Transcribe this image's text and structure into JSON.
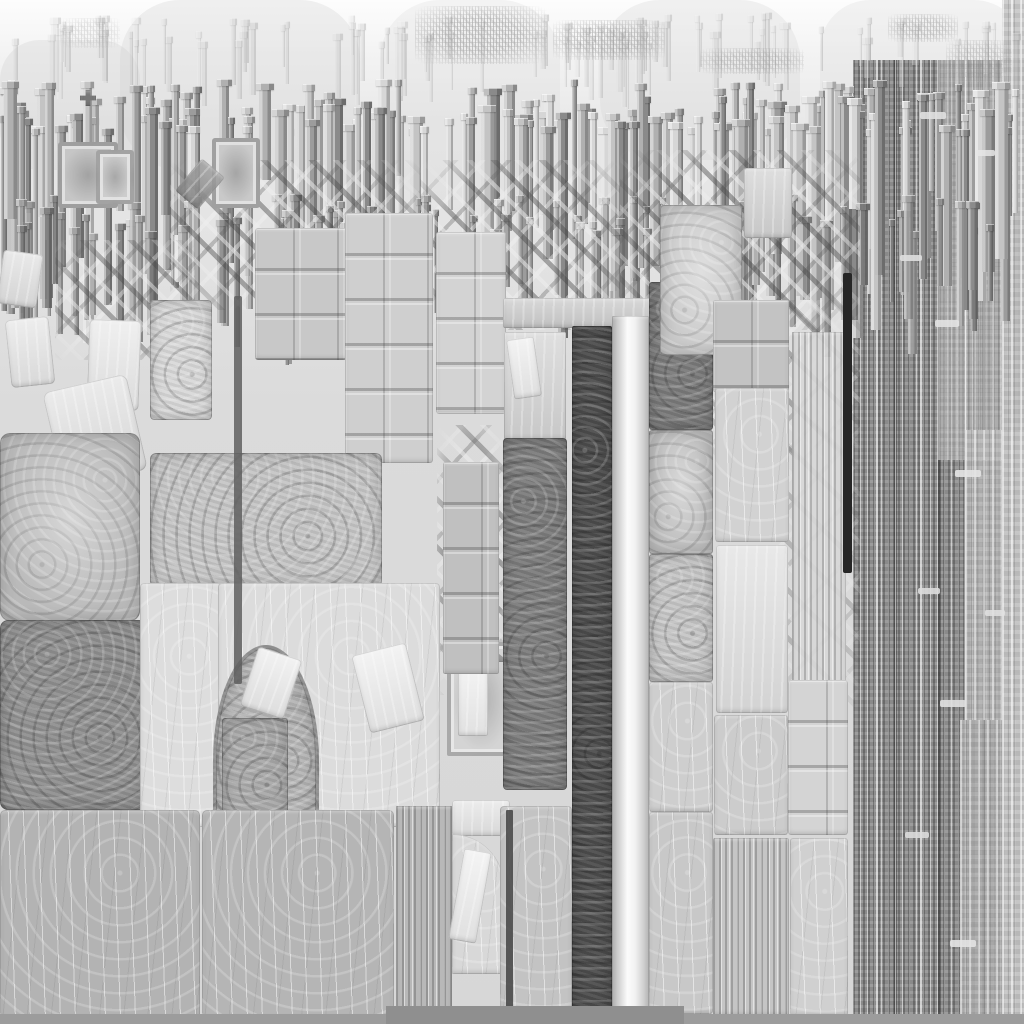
{
  "meta": {
    "description": "abstract grayscale stone/heightmap texture resembling a weathered cathedral facade",
    "width": 1024,
    "height": 1024,
    "palette": {
      "near_white": "#f2f2f2",
      "light_slab": "#dcdcdc",
      "mid_slab": "#c6c6c6",
      "stone_gray": "#b4b4b4",
      "dark_mottle": "#8f8f8f",
      "darker_mottle": "#7a7a7a",
      "dark_strip": "#4d4d4d",
      "black_rod": "#262626",
      "bottom_band": "#9c9c9c"
    }
  },
  "shades": [
    {
      "x": 120,
      "y": 0,
      "w": 240,
      "h": 170,
      "c": "#cfcfcf",
      "o": 0.3,
      "r": 60
    },
    {
      "x": 380,
      "y": 0,
      "w": 180,
      "h": 200,
      "c": "#d6d6d6",
      "o": 0.25,
      "r": 60
    },
    {
      "x": 600,
      "y": 0,
      "w": 200,
      "h": 160,
      "c": "#d4d4d4",
      "o": 0.3,
      "r": 60
    },
    {
      "x": 820,
      "y": 0,
      "w": 204,
      "h": 150,
      "c": "#d9d9d9",
      "o": 0.3,
      "r": 50
    },
    {
      "x": 0,
      "y": 40,
      "w": 140,
      "h": 130,
      "c": "#cccccc",
      "o": 0.3,
      "r": 40
    }
  ],
  "stripe_panels": [
    {
      "x": 853,
      "y": 60,
      "w": 171,
      "h": 956,
      "c": "#949494",
      "variant": "dark",
      "o": 1
    },
    {
      "x": 938,
      "y": 60,
      "w": 66,
      "h": 400,
      "c": "#c6c6c6",
      "variant": "lt",
      "o": 0.55
    },
    {
      "x": 965,
      "y": 430,
      "w": 59,
      "h": 290,
      "c": "#bdbdbd",
      "variant": "lt",
      "o": 0.8
    },
    {
      "x": 960,
      "y": 720,
      "w": 64,
      "h": 296,
      "c": "#b3b3b3",
      "variant": "lt",
      "o": 0.8
    },
    {
      "x": 1002,
      "y": 0,
      "w": 22,
      "h": 1016,
      "c": "#c4c4c4",
      "variant": "lt",
      "o": 0.9
    }
  ],
  "picket_bands": [
    {
      "seed": 11,
      "count": 90,
      "x0": 0,
      "x1": 1024,
      "top": 18,
      "topJitter": 30,
      "minW": 3,
      "maxW": 8,
      "minH": 30,
      "maxH": 70,
      "o": 0.35,
      "shades": [
        "#c4c4c4",
        "#cecece",
        "#d8d8d8",
        "#e2e2e2"
      ]
    },
    {
      "seed": 7,
      "count": 170,
      "x0": 0,
      "x1": 1024,
      "top": 85,
      "topJitter": 50,
      "minW": 4,
      "maxW": 13,
      "minH": 80,
      "maxH": 230,
      "o": 1,
      "shades": [
        "#8a8a8a",
        "#9c9c9c",
        "#b0b0b0",
        "#c4c4c4",
        "#d6d6d6"
      ]
    },
    {
      "seed": 23,
      "count": 80,
      "x0": 0,
      "x1": 1024,
      "top": 200,
      "topJitter": 40,
      "minW": 4,
      "maxW": 10,
      "minH": 60,
      "maxH": 135,
      "o": 0.9,
      "shades": [
        "#7b7b7b",
        "#8d8d8d",
        "#a0a0a0",
        "#b2b2b2"
      ]
    }
  ],
  "filigree": [
    {
      "x": 415,
      "y": 6,
      "w": 132,
      "h": 58,
      "o": 0.55
    },
    {
      "x": 553,
      "y": 20,
      "w": 112,
      "h": 40,
      "o": 0.5
    },
    {
      "x": 700,
      "y": 48,
      "w": 104,
      "h": 26,
      "o": 0.45
    },
    {
      "x": 888,
      "y": 14,
      "w": 70,
      "h": 28,
      "o": 0.45
    },
    {
      "x": 946,
      "y": 40,
      "w": 66,
      "h": 42,
      "o": 0.4
    },
    {
      "x": 60,
      "y": 18,
      "w": 60,
      "h": 30,
      "o": 0.25
    }
  ],
  "hatch_zones": [
    {
      "x": 170,
      "y": 160,
      "w": 250,
      "h": 150,
      "o": 0.85,
      "lt": false
    },
    {
      "x": 420,
      "y": 160,
      "w": 200,
      "h": 170,
      "o": 0.85,
      "lt": false
    },
    {
      "x": 620,
      "y": 150,
      "w": 240,
      "h": 180,
      "o": 0.9,
      "lt": false
    },
    {
      "x": 585,
      "y": 300,
      "w": 130,
      "h": 170,
      "o": 0.9,
      "lt": false
    },
    {
      "x": 437,
      "y": 425,
      "w": 70,
      "h": 270,
      "o": 0.9,
      "lt": false
    },
    {
      "x": 55,
      "y": 240,
      "w": 140,
      "h": 120,
      "o": 0.8,
      "lt": true
    },
    {
      "x": 700,
      "y": 300,
      "w": 160,
      "h": 160,
      "o": 0.7,
      "lt": true
    },
    {
      "x": 770,
      "y": 420,
      "w": 90,
      "h": 300,
      "o": 0.5,
      "lt": true
    }
  ],
  "blocks": [
    {
      "n": "white-chip",
      "x": 8,
      "y": 318,
      "w": 44,
      "h": 68,
      "c": "#e9e9e9",
      "t": "sm",
      "r": 5,
      "rot": -6
    },
    {
      "n": "white-chip",
      "x": 88,
      "y": 320,
      "w": 52,
      "h": 90,
      "c": "#ececec",
      "t": "sm",
      "r": 5,
      "rot": 2
    },
    {
      "n": "white-chip",
      "x": 0,
      "y": 252,
      "w": 40,
      "h": 54,
      "c": "#e4e4e4",
      "t": "sm",
      "r": 4,
      "rot": 8
    },
    {
      "n": "tilted-slab",
      "x": 52,
      "y": 382,
      "w": 86,
      "h": 98,
      "c": "#e6e6e6",
      "t": "sm",
      "r": 8,
      "rot": -13
    },
    {
      "n": "column-piece",
      "x": 150,
      "y": 300,
      "w": 62,
      "h": 120,
      "c": "#d9d9d9",
      "t": "mo",
      "r": 4
    },
    {
      "n": "niche-frame",
      "x": 58,
      "y": 142,
      "w": 52,
      "h": 58,
      "c": "#c6c6c6",
      "t": "fr",
      "r": 3
    },
    {
      "n": "niche-frame",
      "x": 96,
      "y": 150,
      "w": 30,
      "h": 46,
      "c": "#cccccc",
      "t": "fr",
      "r": 3
    },
    {
      "n": "niche-frame",
      "x": 212,
      "y": 138,
      "w": 40,
      "h": 62,
      "c": "#c9c9c9",
      "t": "fr",
      "r": 3
    },
    {
      "n": "dark-chunk",
      "x": 185,
      "y": 163,
      "w": 30,
      "h": 42,
      "c": "#8a8a8a",
      "t": "sm",
      "r": 3,
      "rot": 40,
      "o": 0.85
    },
    {
      "n": "block-stack",
      "x": 255,
      "y": 228,
      "w": 92,
      "h": 132,
      "c": "#c8c8c8",
      "t": "gr",
      "r": 3
    },
    {
      "n": "block-stack",
      "x": 345,
      "y": 213,
      "w": 88,
      "h": 250,
      "c": "#cfcfcf",
      "t": "gr",
      "r": 3
    },
    {
      "n": "block-stack",
      "x": 436,
      "y": 232,
      "w": 70,
      "h": 182,
      "c": "#d3d3d3",
      "t": "gr",
      "r": 3
    },
    {
      "n": "wide-slab",
      "x": 150,
      "y": 453,
      "w": 232,
      "h": 134,
      "c": "#c6c6c6",
      "t": "mo",
      "r": 6
    },
    {
      "n": "slab-worn",
      "x": 0,
      "y": 433,
      "w": 140,
      "h": 188,
      "c": "#b9b9b9",
      "t": "mol",
      "r": 10
    },
    {
      "n": "slab-dark",
      "x": 0,
      "y": 620,
      "w": 147,
      "h": 190,
      "c": "#8f8f8f",
      "t": "mo",
      "r": 8
    },
    {
      "n": "slab-light",
      "x": 140,
      "y": 583,
      "w": 82,
      "h": 244,
      "c": "#dddddd",
      "t": "sc",
      "r": 4
    },
    {
      "n": "slab-light-arch-host",
      "x": 218,
      "y": 583,
      "w": 222,
      "h": 244,
      "c": "#dcdcdc",
      "t": "sc",
      "r": 4
    },
    {
      "n": "arch-opening",
      "x": 213,
      "y": 645,
      "w": 100,
      "h": 182,
      "c": "#b6b6b6",
      "t": "arch"
    },
    {
      "n": "arch-column",
      "x": 222,
      "y": 718,
      "w": 66,
      "h": 108,
      "c": "#a9a9a9",
      "t": "mo",
      "r": 3
    },
    {
      "n": "arch-debris",
      "x": 248,
      "y": 652,
      "w": 46,
      "h": 62,
      "c": "#eeeeee",
      "t": "sm",
      "r": 4,
      "rot": 18
    },
    {
      "n": "arch-debris",
      "x": 360,
      "y": 648,
      "w": 56,
      "h": 80,
      "c": "#f0f0f0",
      "t": "sm",
      "r": 4,
      "rot": -14
    },
    {
      "n": "niche-block",
      "x": 447,
      "y": 642,
      "w": 60,
      "h": 106,
      "c": "#d4d4d4",
      "t": "fr",
      "r": 2
    },
    {
      "n": "niche-inner",
      "x": 458,
      "y": 662,
      "w": 30,
      "h": 74,
      "c": "#f2f2f2",
      "t": "sm",
      "r": 2
    },
    {
      "n": "pediment",
      "x": 445,
      "y": 636,
      "w": 64,
      "h": 26,
      "c": "#8c8c8c",
      "t": "fl",
      "o": 0.8,
      "clip": "polygon(0 100%,50% 0,100% 100%,78% 100%,50% 34%,22% 100%)"
    },
    {
      "n": "framed-cells",
      "x": 443,
      "y": 462,
      "w": 56,
      "h": 212,
      "c": "#c0c0c0",
      "t": "gr",
      "r": 2
    },
    {
      "n": "fragment-zone",
      "x": 504,
      "y": 332,
      "w": 62,
      "h": 108,
      "c": "#d7d7d7",
      "t": "sm",
      "r": 2
    },
    {
      "n": "white-chip",
      "x": 510,
      "y": 338,
      "w": 28,
      "h": 60,
      "c": "#f0f0f0",
      "t": "sm",
      "r": 3,
      "rot": -8
    },
    {
      "n": "slab-dark-center",
      "x": 503,
      "y": 438,
      "w": 64,
      "h": 352,
      "c": "#7c7c7c",
      "t": "mo",
      "r": 4
    },
    {
      "n": "lintel",
      "x": 503,
      "y": 298,
      "w": 148,
      "h": 30,
      "c": "#cfcfcf",
      "t": "sm",
      "r": 2
    },
    {
      "n": "dark-strip",
      "x": 572,
      "y": 326,
      "w": 40,
      "h": 690,
      "c": "#4d4d4d",
      "t": "mo",
      "r": 2
    },
    {
      "n": "light-strip",
      "x": 612,
      "y": 316,
      "w": 37,
      "h": 702,
      "c": "#dadada",
      "t": "glow",
      "r": 1
    },
    {
      "n": "slab-dark",
      "x": 649,
      "y": 282,
      "w": 64,
      "h": 148,
      "c": "#7a7a7a",
      "t": "mo",
      "r": 3
    },
    {
      "n": "slab",
      "x": 649,
      "y": 430,
      "w": 64,
      "h": 124,
      "c": "#bdbdbd",
      "t": "mol",
      "r": 3
    },
    {
      "n": "slab",
      "x": 649,
      "y": 554,
      "w": 64,
      "h": 128,
      "c": "#c6c6c6",
      "t": "mo",
      "r": 3
    },
    {
      "n": "slab",
      "x": 649,
      "y": 682,
      "w": 64,
      "h": 130,
      "c": "#cecece",
      "t": "sc",
      "r": 3
    },
    {
      "n": "slab",
      "x": 649,
      "y": 812,
      "w": 64,
      "h": 202,
      "c": "#c8c8c8",
      "t": "sc",
      "r": 3
    },
    {
      "n": "slab-top",
      "x": 660,
      "y": 205,
      "w": 82,
      "h": 150,
      "c": "#c9c9c9",
      "t": "mol",
      "r": 4
    },
    {
      "n": "slab-top",
      "x": 744,
      "y": 168,
      "w": 48,
      "h": 70,
      "c": "#d6d6d6",
      "t": "sm",
      "r": 3
    },
    {
      "n": "block-stack",
      "x": 713,
      "y": 300,
      "w": 76,
      "h": 92,
      "c": "#c3c3c3",
      "t": "gr",
      "r": 2
    },
    {
      "n": "slab",
      "x": 715,
      "y": 388,
      "w": 74,
      "h": 154,
      "c": "#d2d2d2",
      "t": "sc",
      "r": 3
    },
    {
      "n": "slab-bright",
      "x": 716,
      "y": 545,
      "w": 72,
      "h": 168,
      "c": "#e3e3e3",
      "t": "sm",
      "r": 3
    },
    {
      "n": "slab",
      "x": 714,
      "y": 715,
      "w": 74,
      "h": 120,
      "c": "#cccccc",
      "t": "sc",
      "r": 3
    },
    {
      "n": "striped-column",
      "x": 713,
      "y": 838,
      "w": 76,
      "h": 178,
      "c": "#c5c5c5",
      "t": "st",
      "r": 2
    },
    {
      "n": "striped-zone",
      "x": 792,
      "y": 332,
      "w": 54,
      "h": 500,
      "c": "#d8d8d8",
      "t": "st",
      "r": 0,
      "o": 0.9
    },
    {
      "n": "jointed-slab",
      "x": 788,
      "y": 680,
      "w": 60,
      "h": 155,
      "c": "#d4d4d4",
      "t": "gr",
      "r": 3
    },
    {
      "n": "slab",
      "x": 790,
      "y": 838,
      "w": 58,
      "h": 178,
      "c": "#d0d0d0",
      "t": "sc",
      "r": 3
    },
    {
      "n": "floor-slab",
      "x": 0,
      "y": 810,
      "w": 200,
      "h": 210,
      "c": "#b3b3b3",
      "t": "sc",
      "r": 5
    },
    {
      "n": "floor-slab",
      "x": 202,
      "y": 810,
      "w": 192,
      "h": 210,
      "c": "#b5b5b5",
      "t": "sc",
      "r": 5
    },
    {
      "n": "pilaster-strip",
      "x": 396,
      "y": 806,
      "w": 56,
      "h": 212,
      "c": "#b8b8b8",
      "t": "st",
      "r": 0
    },
    {
      "n": "white-ledge",
      "x": 452,
      "y": 800,
      "w": 58,
      "h": 36,
      "c": "#e8e8e8",
      "t": "sm",
      "r": 3
    },
    {
      "n": "arch-fragment",
      "x": 452,
      "y": 834,
      "w": 52,
      "h": 140,
      "c": "#d8d8d8",
      "t": "sc",
      "r": 0,
      "rtr": 55
    },
    {
      "n": "white-wedge",
      "x": 456,
      "y": 850,
      "w": 28,
      "h": 92,
      "c": "#f1f1f1",
      "t": "sm",
      "r": 3,
      "rot": 10
    },
    {
      "n": "slab",
      "x": 500,
      "y": 806,
      "w": 72,
      "h": 210,
      "c": "#c3c3c3",
      "t": "sc",
      "r": 4
    },
    {
      "n": "cross-mark",
      "x": 80,
      "y": 90,
      "w": 16,
      "h": 16,
      "c": "#787878",
      "t": "fl",
      "clip": "polygon(35% 0,65% 0,65% 35%,100% 35%,100% 65%,65% 65%,65% 100%,35% 100%,35% 65%,0 65%,0 35%,35% 35%)"
    }
  ],
  "details": [
    {
      "n": "black-rod",
      "x": 843,
      "y": 273,
      "w": 9,
      "h": 300,
      "c": "#262626",
      "r": 2,
      "o": 1
    },
    {
      "n": "dark-seam",
      "x": 234,
      "y": 296,
      "w": 8,
      "h": 388,
      "c": "#5f5f5f",
      "r": 2,
      "o": 0.85
    },
    {
      "n": "dark-seam",
      "x": 506,
      "y": 810,
      "w": 7,
      "h": 206,
      "c": "#4a4a4a",
      "r": 1,
      "o": 0.9
    },
    {
      "n": "bottom-band",
      "x": 0,
      "y": 1014,
      "w": 1024,
      "h": 10,
      "c": "#9c9c9c",
      "r": 0,
      "o": 1
    },
    {
      "n": "bottom-band-dark",
      "x": 386,
      "y": 1006,
      "w": 298,
      "h": 18,
      "c": "#8f8f8f",
      "r": 0,
      "o": 1
    },
    {
      "n": "panel-dash",
      "x": 920,
      "y": 112,
      "w": 26,
      "h": 7,
      "c": "#e0e0e0",
      "r": 2,
      "o": 0.9
    },
    {
      "n": "panel-dash",
      "x": 900,
      "y": 255,
      "w": 22,
      "h": 6,
      "c": "#dedede",
      "r": 2,
      "o": 0.9
    },
    {
      "n": "panel-dash",
      "x": 935,
      "y": 320,
      "w": 24,
      "h": 7,
      "c": "#e2e2e2",
      "r": 2,
      "o": 0.9
    },
    {
      "n": "panel-dash",
      "x": 955,
      "y": 470,
      "w": 26,
      "h": 7,
      "c": "#e4e4e4",
      "r": 2,
      "o": 0.9
    },
    {
      "n": "panel-dash",
      "x": 918,
      "y": 588,
      "w": 22,
      "h": 6,
      "c": "#dddddd",
      "r": 2,
      "o": 0.9
    },
    {
      "n": "panel-dash",
      "x": 940,
      "y": 700,
      "w": 26,
      "h": 7,
      "c": "#e0e0e0",
      "r": 2,
      "o": 0.9
    },
    {
      "n": "panel-dash",
      "x": 905,
      "y": 832,
      "w": 24,
      "h": 6,
      "c": "#dcdcdc",
      "r": 2,
      "o": 0.9
    },
    {
      "n": "panel-dash",
      "x": 950,
      "y": 940,
      "w": 26,
      "h": 7,
      "c": "#e3e3e3",
      "r": 2,
      "o": 0.9
    },
    {
      "n": "panel-dash",
      "x": 975,
      "y": 150,
      "w": 20,
      "h": 6,
      "c": "#e6e6e6",
      "r": 2,
      "o": 0.85
    },
    {
      "n": "panel-dash",
      "x": 985,
      "y": 610,
      "w": 20,
      "h": 6,
      "c": "#e1e1e1",
      "r": 2,
      "o": 0.85
    }
  ]
}
